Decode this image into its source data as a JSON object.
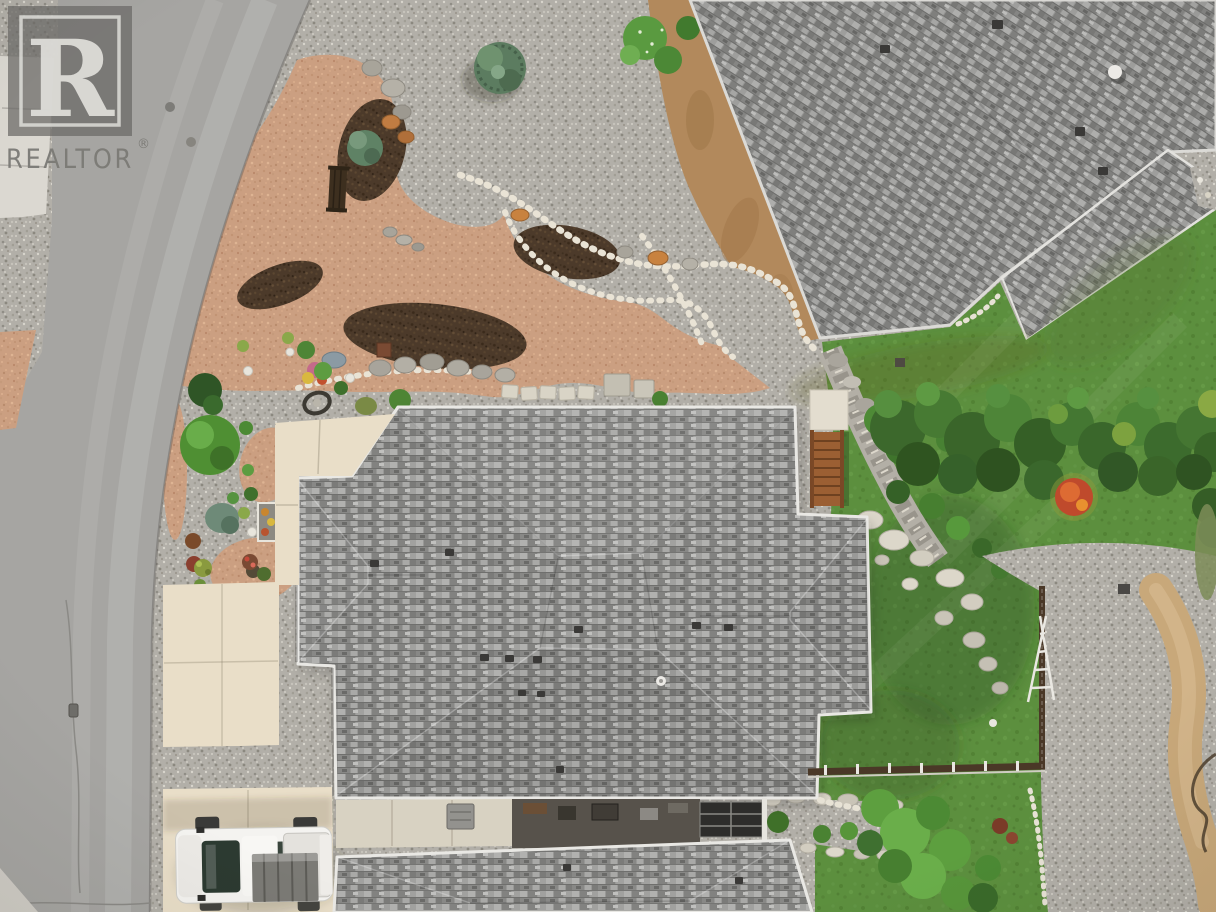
{
  "watermark": {
    "logo_letter": "R",
    "brand": "REALTOR",
    "registered_mark": "®"
  },
  "scene": {
    "type": "aerial-drone-photo",
    "description": "Overhead aerial view of a residential property: gray asphalt-shingle hip roofs, xeriscaped rock and gravel front yard with dry creek bed and boulders, curved asphalt street, cream concrete driveway with a white pickup truck, neighboring roof at top right, green lawns, shrub hedge with one red bush, brown wooden fence, wooden deck stairs and gravel paths"
  },
  "objects": {
    "street": "curved asphalt road",
    "sidewalk": "concrete sidewalk",
    "driveway": "cream concrete driveway",
    "truck": "white pickup truck with cargo in bed",
    "main_roof": "gray shingle hip roof of main house",
    "neighbor_roof": "neighboring gray shingle roof",
    "lower_roof": "lower shingle roof at bottom",
    "front_yard": "xeriscape gravel garden with dry creek bed, mulch beds and boulders",
    "bench": "garden bench",
    "lawn": "green lawn",
    "hedge": "shrub hedge with red accent bush",
    "fence": "brown wooden fence",
    "stairs": "wooden deck stairs",
    "trellis": "white garden trellis ladder",
    "hose": "garden hose on sand path"
  },
  "palette": {
    "road": "#a6a5a2",
    "sidewalk": "#dbd8d1",
    "driveway": "#e9dec8",
    "gravel": "#b2afa8",
    "granite": "#cb9f81",
    "mulch": "#4c3a2a",
    "white_rock": "#e9e3d5",
    "roof_main": "#98989a",
    "fascia": "#eceae4",
    "lawn": "#5c8f3e",
    "hedge": "#3f6b2d",
    "red_bush": "#bf4a2c",
    "fence": "#4a3827",
    "deck_wood": "#9b5f33",
    "truck_body": "#f4f3f0",
    "truck_glass": "#2c3a31",
    "cargo": "#7b7a75",
    "dirt": "#b2895c",
    "sand_path": "#c8a87a"
  }
}
